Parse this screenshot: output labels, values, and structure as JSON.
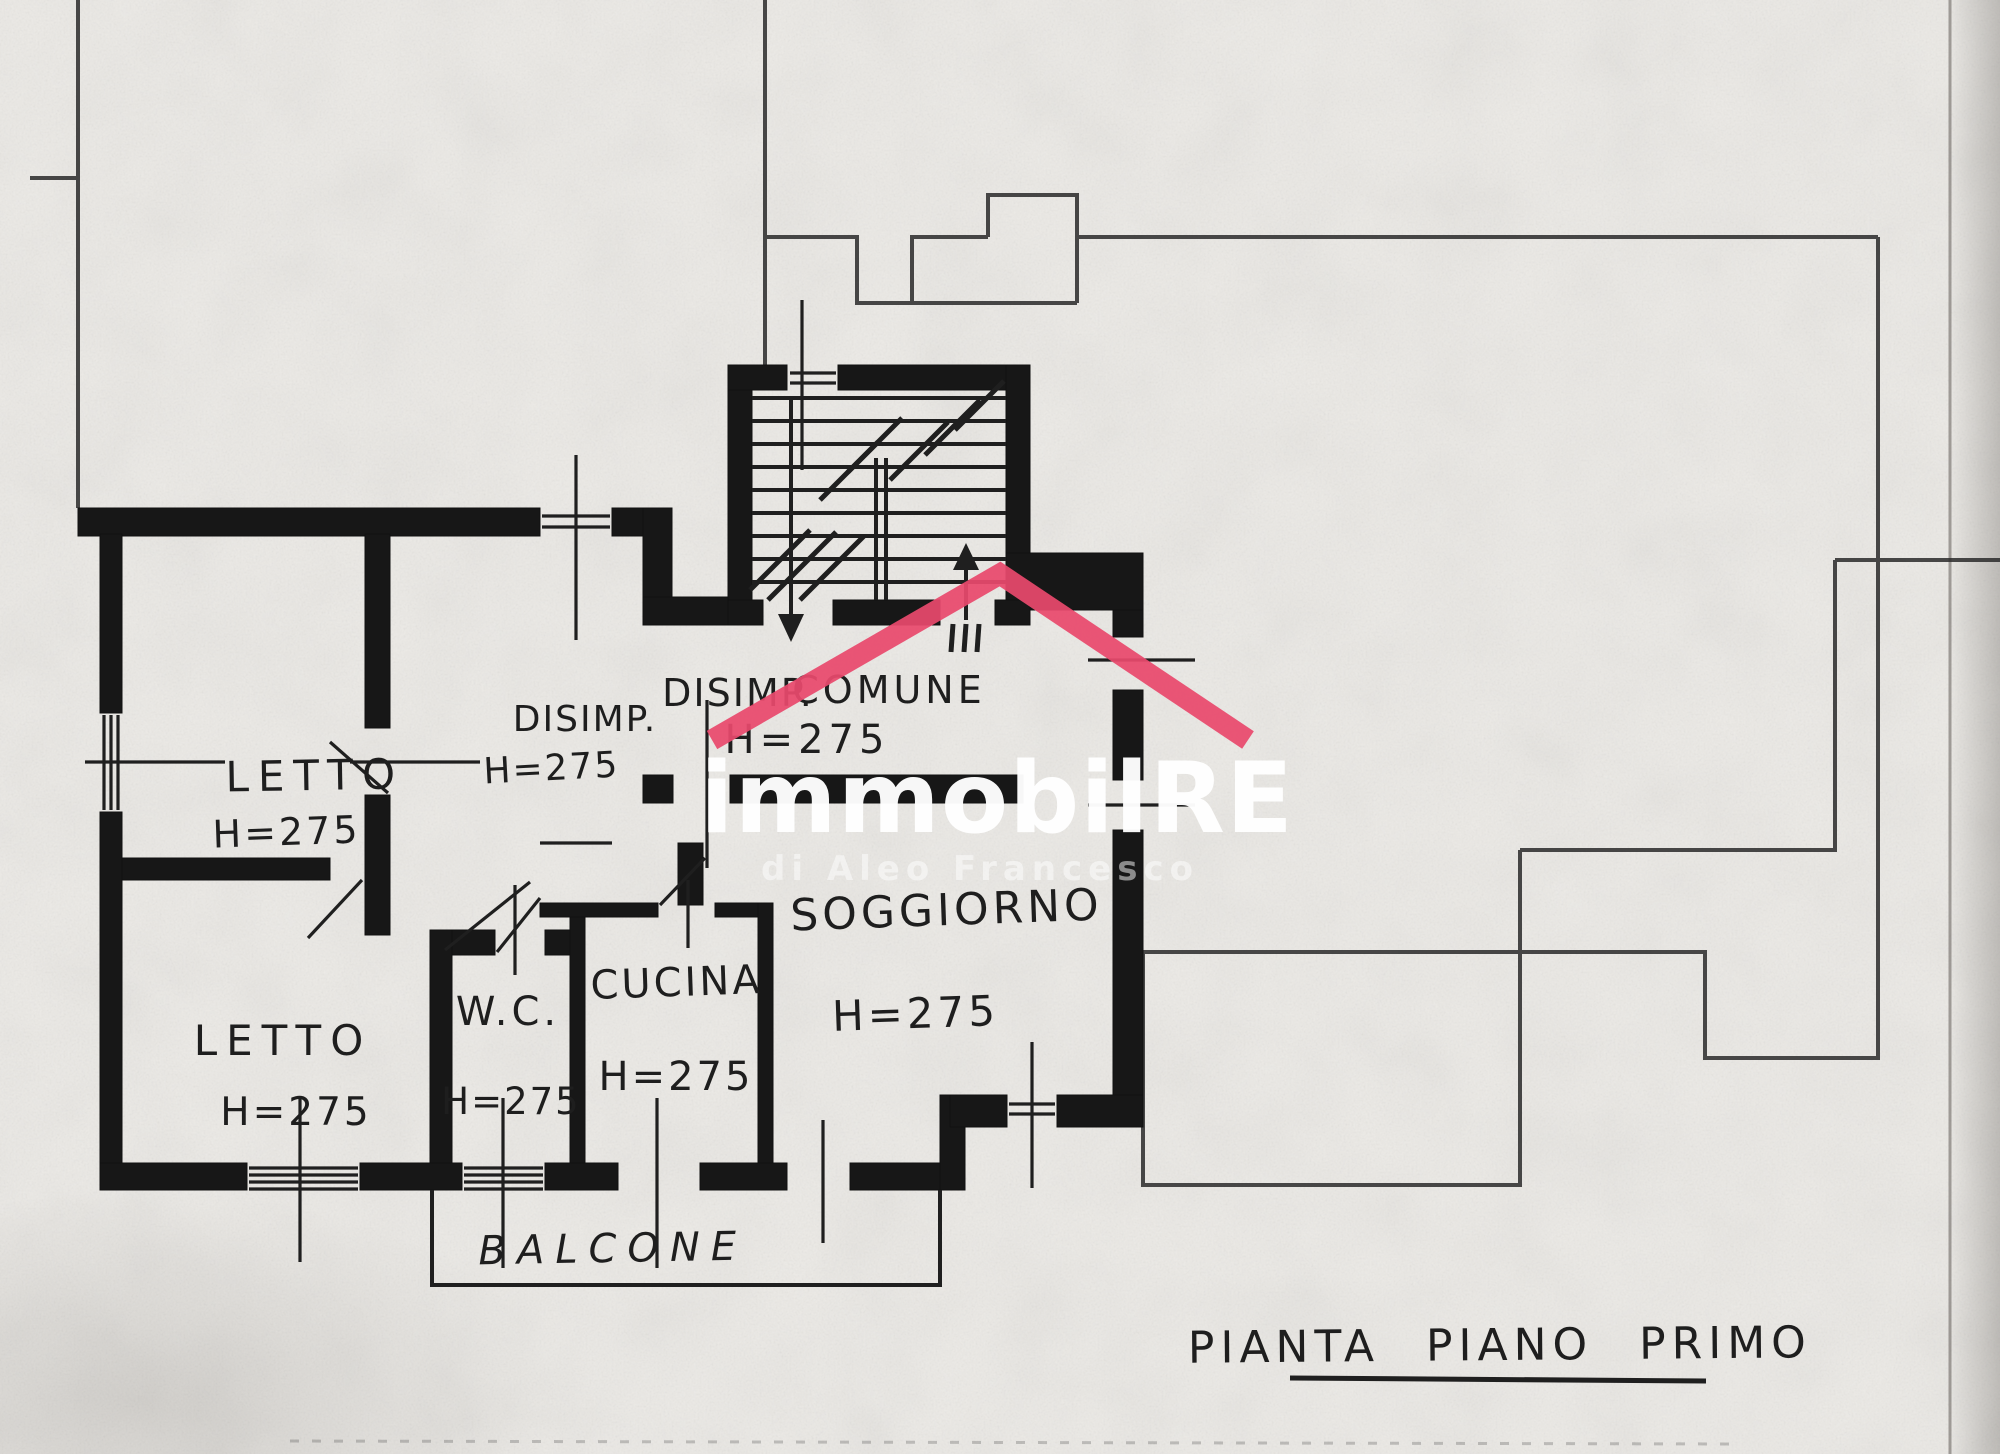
{
  "plan": {
    "caption": "PIANTA PIANO PRIMO",
    "rooms": {
      "letto1": {
        "label": "LETTO",
        "height": "H=275"
      },
      "letto2": {
        "label": "LETTO",
        "height": "H=275"
      },
      "wc": {
        "label": "W.C.",
        "height": "H=275"
      },
      "cucina": {
        "label": "CUCINA",
        "height": "H=275"
      },
      "soggiorno": {
        "label": "SOGGIORNO",
        "height": "H=275"
      },
      "disimpegno": {
        "label": "DISIMP.",
        "height": "H=275"
      },
      "disimpegno_comune": {
        "label_left": "DISIMP.",
        "label_right": "COMUNE",
        "height": "H=275"
      },
      "balcone": {
        "label": "BALCONE"
      }
    }
  },
  "watermark": {
    "brand": "immobilRE",
    "subtitle": "di Aleo Francesco",
    "roof_color": "#e8496d",
    "text_color": "#ffffff"
  },
  "colors": {
    "paper": "#eceae6",
    "ink": "#1f1f1f"
  }
}
